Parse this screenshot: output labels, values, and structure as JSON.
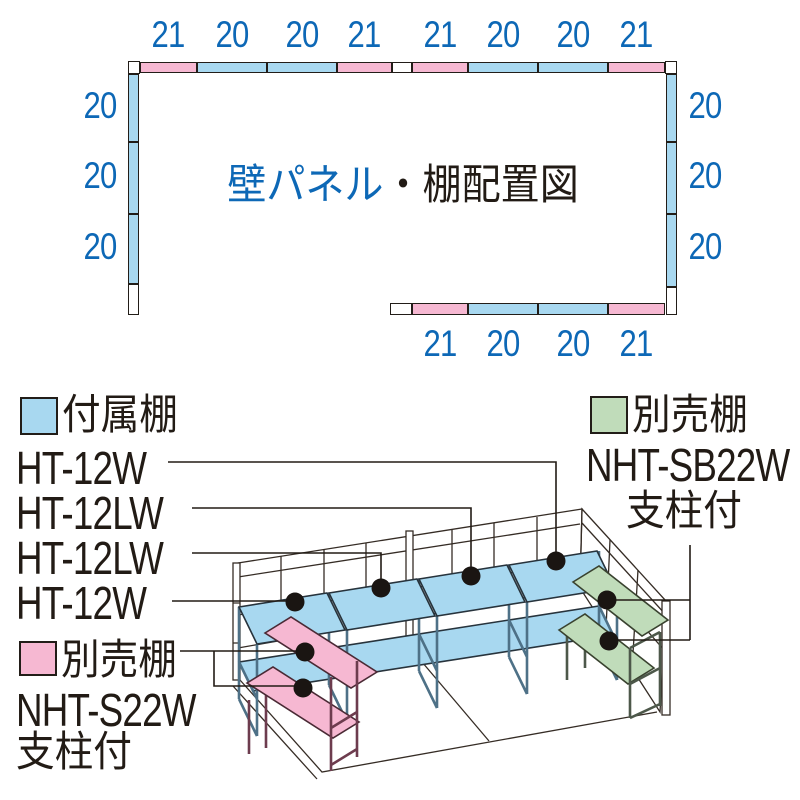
{
  "title": {
    "blue_part": "壁パネル",
    "black_part": "・棚配置図"
  },
  "colors": {
    "accent_blue": "#0d68b6",
    "panel_blue": "#a8d8f0",
    "panel_pink": "#f6b8d2",
    "panel_green": "#c0dcba",
    "ink": "#221b15"
  },
  "plan": {
    "top_labels": [
      "21",
      "20",
      "20",
      "21",
      "21",
      "20",
      "20",
      "21"
    ],
    "bottom_labels": [
      "21",
      "20",
      "20",
      "21"
    ],
    "left_labels": [
      "20",
      "20",
      "20"
    ],
    "right_labels": [
      "20",
      "20",
      "20"
    ]
  },
  "legend_included": {
    "title": "付属棚",
    "models": [
      "HT-12W",
      "HT-12LW",
      "HT-12LW",
      "HT-12W"
    ]
  },
  "legend_optional_green": {
    "title": "別売棚",
    "model": "NHT-SB22W",
    "note": "支柱付"
  },
  "legend_optional_pink": {
    "title": "別売棚",
    "model": "NHT-S22W",
    "note": "支柱付"
  }
}
